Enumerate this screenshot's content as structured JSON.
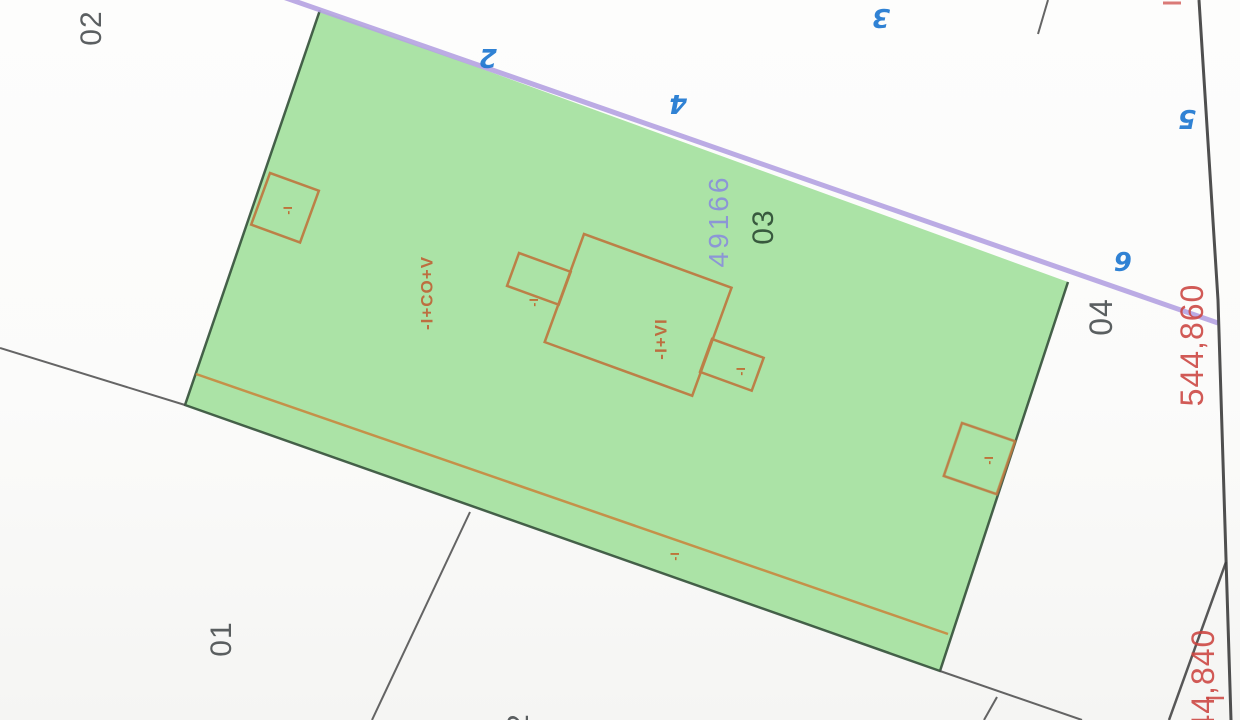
{
  "plan": {
    "parcel_number_label": "49166",
    "zone_labels": {
      "z01": "01",
      "z02": "02",
      "z03": "03",
      "z04": "04",
      "partial_bottom": "2"
    },
    "street_numbers": {
      "n2": "2",
      "n3": "3",
      "n4": "4",
      "n5": "5",
      "n6": "6"
    },
    "coordinate_labels": {
      "top": "544,860",
      "bottom": "544,840"
    },
    "building_labels": {
      "wing": "-I+CO+V",
      "main": "-I+VI",
      "annex": "-I"
    },
    "colors": {
      "parcel_fill": "#abe3a6",
      "street_line": "#b5a3e2",
      "building_outline": "#bd7b42",
      "inner_orange_line": "#c8893f",
      "parcel_boundary": "#34503a",
      "neighbor_line": "#4a4a4a",
      "street_number_blue": "#1f78d1",
      "parcel_number_violet": "#8b92d8",
      "coordinate_red": "#cc4440",
      "zone_label_dark": "#3f4446"
    }
  }
}
